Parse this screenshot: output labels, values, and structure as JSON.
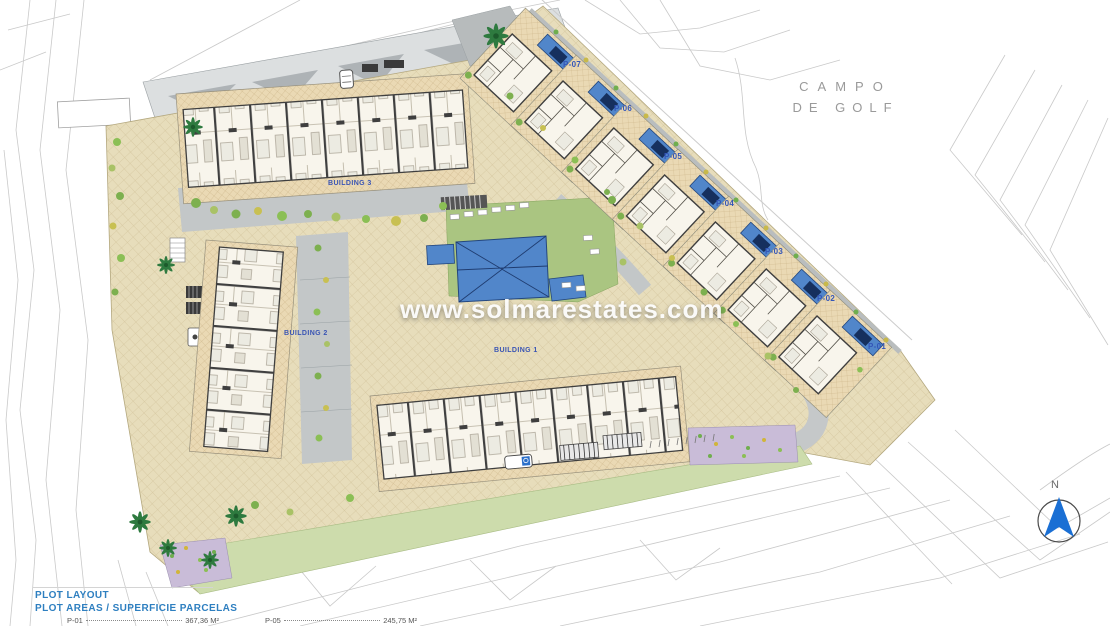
{
  "plan": {
    "watermark": "www.solmarestates.com",
    "golf_area": {
      "line1": "CAMPO",
      "line2": "DE GOLF"
    },
    "north": {
      "label": "N"
    },
    "buildings": [
      {
        "label": "BUILDING 1"
      },
      {
        "label": "BUILDING 2"
      },
      {
        "label": "BUILDING 3"
      }
    ],
    "plots": [
      {
        "label": "P-01"
      },
      {
        "label": "P-02"
      },
      {
        "label": "P-03"
      },
      {
        "label": "P-04"
      },
      {
        "label": "P-05"
      },
      {
        "label": "P-06"
      },
      {
        "label": "P-07"
      }
    ]
  },
  "legend": {
    "title": "PLOT LAYOUT",
    "subtitle": "PLOT AREAS / SUPERFICIE PARCELAS",
    "entries": [
      {
        "code": "P-01",
        "area": "367,36 M²"
      },
      {
        "code": "P-05",
        "area": "245,75 M²"
      }
    ]
  },
  "colors": {
    "legend_blue": "#2e7fc0",
    "label_blue": "#3456b8",
    "pool_blue": "#5186ca",
    "paving_tan": "#e7ddbb",
    "lawn_green": "#aac581",
    "band_green": "#cddcac",
    "road_gray": "#c5c8c9",
    "north_arrow_blue": "#1a6fd4"
  }
}
